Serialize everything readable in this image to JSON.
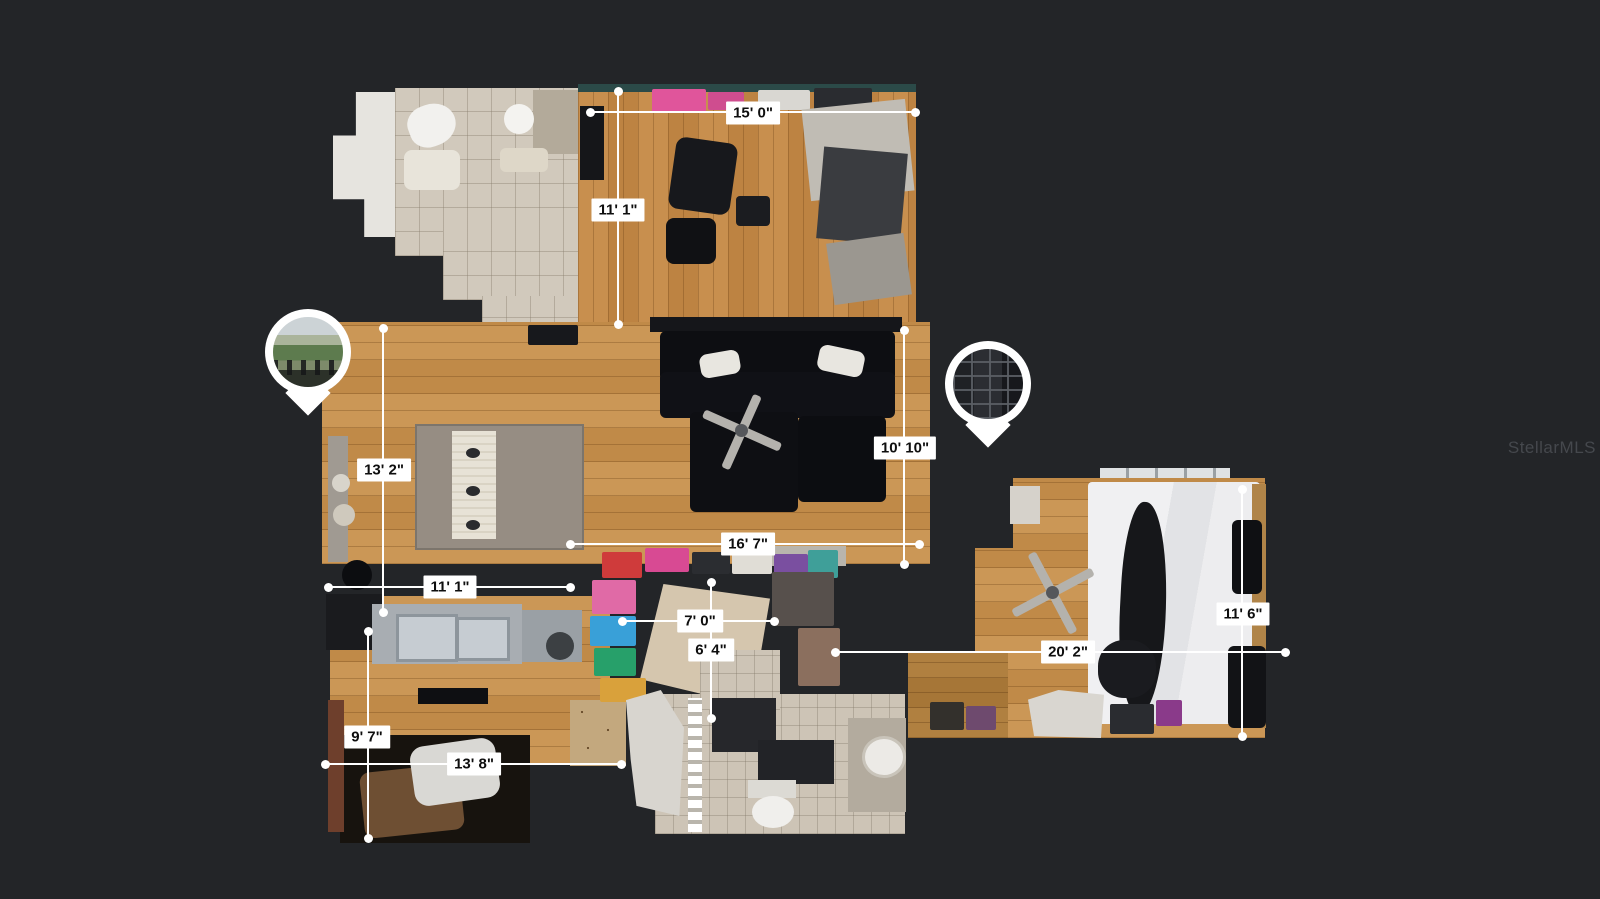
{
  "watermark": "StellarMLS",
  "colors": {
    "background": "#232528",
    "dimension_line": "#ffffff",
    "dimension_label_bg": "#ffffff",
    "dimension_label_text": "#0e0e0e",
    "pin": "#ffffff"
  },
  "measurements": [
    {
      "id": "top-room-width",
      "label": "15' 0\"",
      "orientation": "horizontal"
    },
    {
      "id": "top-room-depth",
      "label": "11' 1\"",
      "orientation": "vertical"
    },
    {
      "id": "living-room-depth",
      "label": "10' 10\"",
      "orientation": "vertical"
    },
    {
      "id": "dining-area-depth",
      "label": "13' 2\"",
      "orientation": "vertical"
    },
    {
      "id": "living-room-width",
      "label": "16' 7\"",
      "orientation": "horizontal"
    },
    {
      "id": "dining-area-width",
      "label": "11' 1\"",
      "orientation": "horizontal"
    },
    {
      "id": "closet-width",
      "label": "7' 0\"",
      "orientation": "horizontal"
    },
    {
      "id": "closet-depth",
      "label": "6' 4\"",
      "orientation": "vertical"
    },
    {
      "id": "bedroom-depth",
      "label": "11' 6\"",
      "orientation": "vertical"
    },
    {
      "id": "bedroom-width",
      "label": "20' 2\"",
      "orientation": "horizontal"
    },
    {
      "id": "kitchen-depth",
      "label": "9' 7\"",
      "orientation": "vertical"
    },
    {
      "id": "kitchen-width",
      "label": "13' 8\"",
      "orientation": "horizontal"
    }
  ],
  "pins": [
    {
      "id": "balcony-view-pin",
      "content": "outdoor balcony photo"
    },
    {
      "id": "french-door-pin",
      "content": "dark french door photo"
    }
  ]
}
